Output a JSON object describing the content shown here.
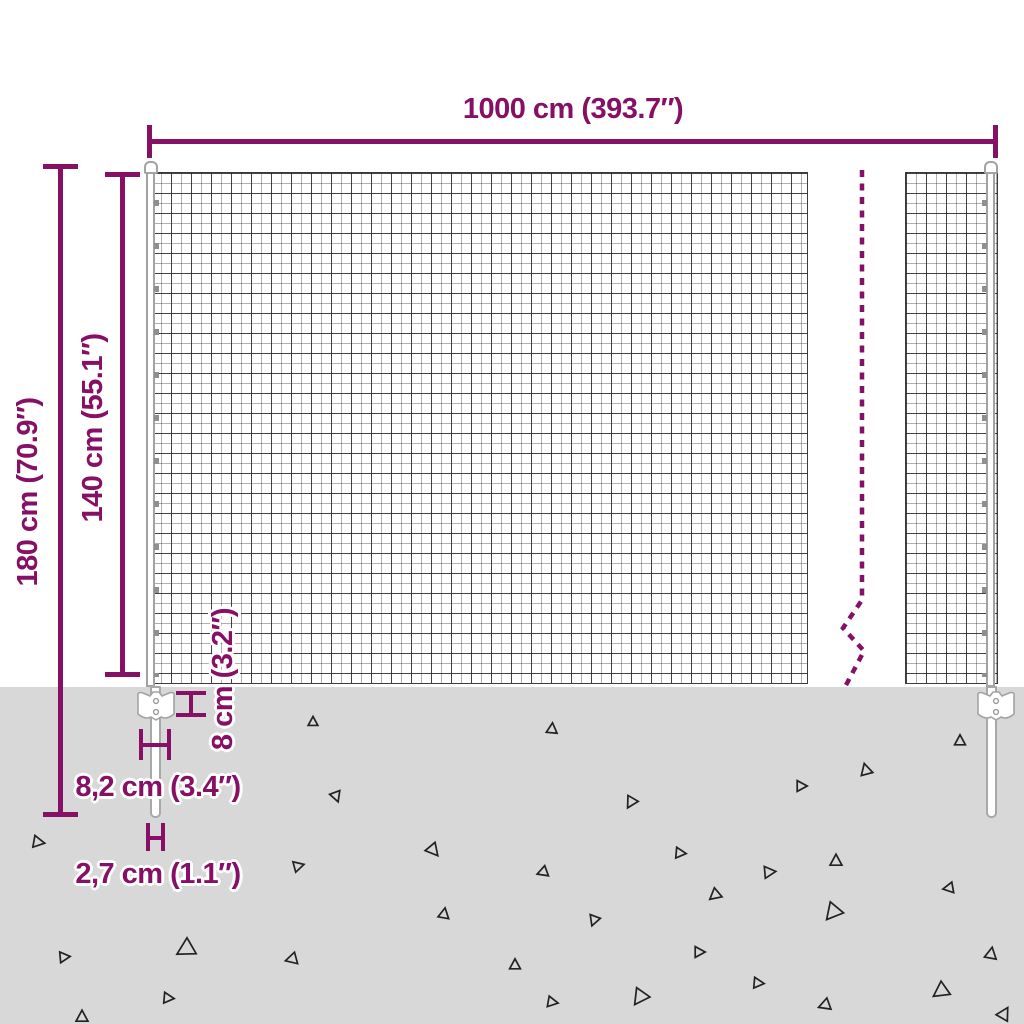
{
  "title": "Wire mesh fence dimension diagram",
  "dimensions": {
    "width": {
      "label": "1000 cm (393.7″)"
    },
    "total_height": {
      "label": "180 cm (70.9″)"
    },
    "mesh_height": {
      "label": "140 cm (55.1″)"
    },
    "anchor_plate_height": {
      "label": "8 cm (3.2″)"
    },
    "anchor_plate_width": {
      "label": "8,2 cm (3.4″)"
    },
    "spike_width": {
      "label": "2,7 cm (1.1″)"
    }
  },
  "colors": {
    "dimension": "#871067",
    "ground": "#d8d8d8",
    "mesh_line": "#3c3c3c",
    "post_border": "#a3a3a3",
    "triangle": "#222222",
    "background": "#ffffff"
  },
  "ground_triangles": [
    {
      "x": 313,
      "y": 722,
      "s": 9,
      "r": 0
    },
    {
      "x": 552,
      "y": 729,
      "s": 10,
      "r": 5
    },
    {
      "x": 960,
      "y": 741,
      "s": 10,
      "r": 0
    },
    {
      "x": 866,
      "y": 770,
      "s": 11,
      "r": -15
    },
    {
      "x": 801,
      "y": 786,
      "s": 10,
      "r": 90
    },
    {
      "x": 631,
      "y": 802,
      "s": 11,
      "r": 210
    },
    {
      "x": 336,
      "y": 796,
      "s": 10,
      "r": 160
    },
    {
      "x": 38,
      "y": 842,
      "s": 11,
      "r": 100
    },
    {
      "x": 433,
      "y": 850,
      "s": 12,
      "r": 140
    },
    {
      "x": 298,
      "y": 866,
      "s": 10,
      "r": 75
    },
    {
      "x": 680,
      "y": 853,
      "s": 10,
      "r": 95
    },
    {
      "x": 543,
      "y": 872,
      "s": 10,
      "r": 250
    },
    {
      "x": 769,
      "y": 872,
      "s": 11,
      "r": 85
    },
    {
      "x": 836,
      "y": 861,
      "s": 11,
      "r": 0
    },
    {
      "x": 444,
      "y": 914,
      "s": 10,
      "r": 10
    },
    {
      "x": 715,
      "y": 895,
      "s": 11,
      "r": 230
    },
    {
      "x": 949,
      "y": 888,
      "s": 10,
      "r": 260
    },
    {
      "x": 594,
      "y": 920,
      "s": 10,
      "r": 200
    },
    {
      "x": 833,
      "y": 912,
      "s": 16,
      "r": 220
    },
    {
      "x": 186,
      "y": 949,
      "s": 17,
      "r": 240
    },
    {
      "x": 64,
      "y": 957,
      "s": 10,
      "r": 85
    },
    {
      "x": 292,
      "y": 959,
      "s": 11,
      "r": 255
    },
    {
      "x": 515,
      "y": 965,
      "s": 10,
      "r": 0
    },
    {
      "x": 699,
      "y": 952,
      "s": 10,
      "r": 90
    },
    {
      "x": 991,
      "y": 954,
      "s": 11,
      "r": 10
    },
    {
      "x": 168,
      "y": 998,
      "s": 10,
      "r": 95
    },
    {
      "x": 552,
      "y": 1002,
      "s": 10,
      "r": 100
    },
    {
      "x": 640,
      "y": 997,
      "s": 15,
      "r": 215
    },
    {
      "x": 758,
      "y": 983,
      "s": 10,
      "r": 95
    },
    {
      "x": 941,
      "y": 991,
      "s": 15,
      "r": 235
    },
    {
      "x": 825,
      "y": 1005,
      "s": 11,
      "r": 250
    },
    {
      "x": 82,
      "y": 1017,
      "s": 11,
      "r": 0
    },
    {
      "x": 1004,
      "y": 1014,
      "s": 12,
      "r": 30
    }
  ]
}
